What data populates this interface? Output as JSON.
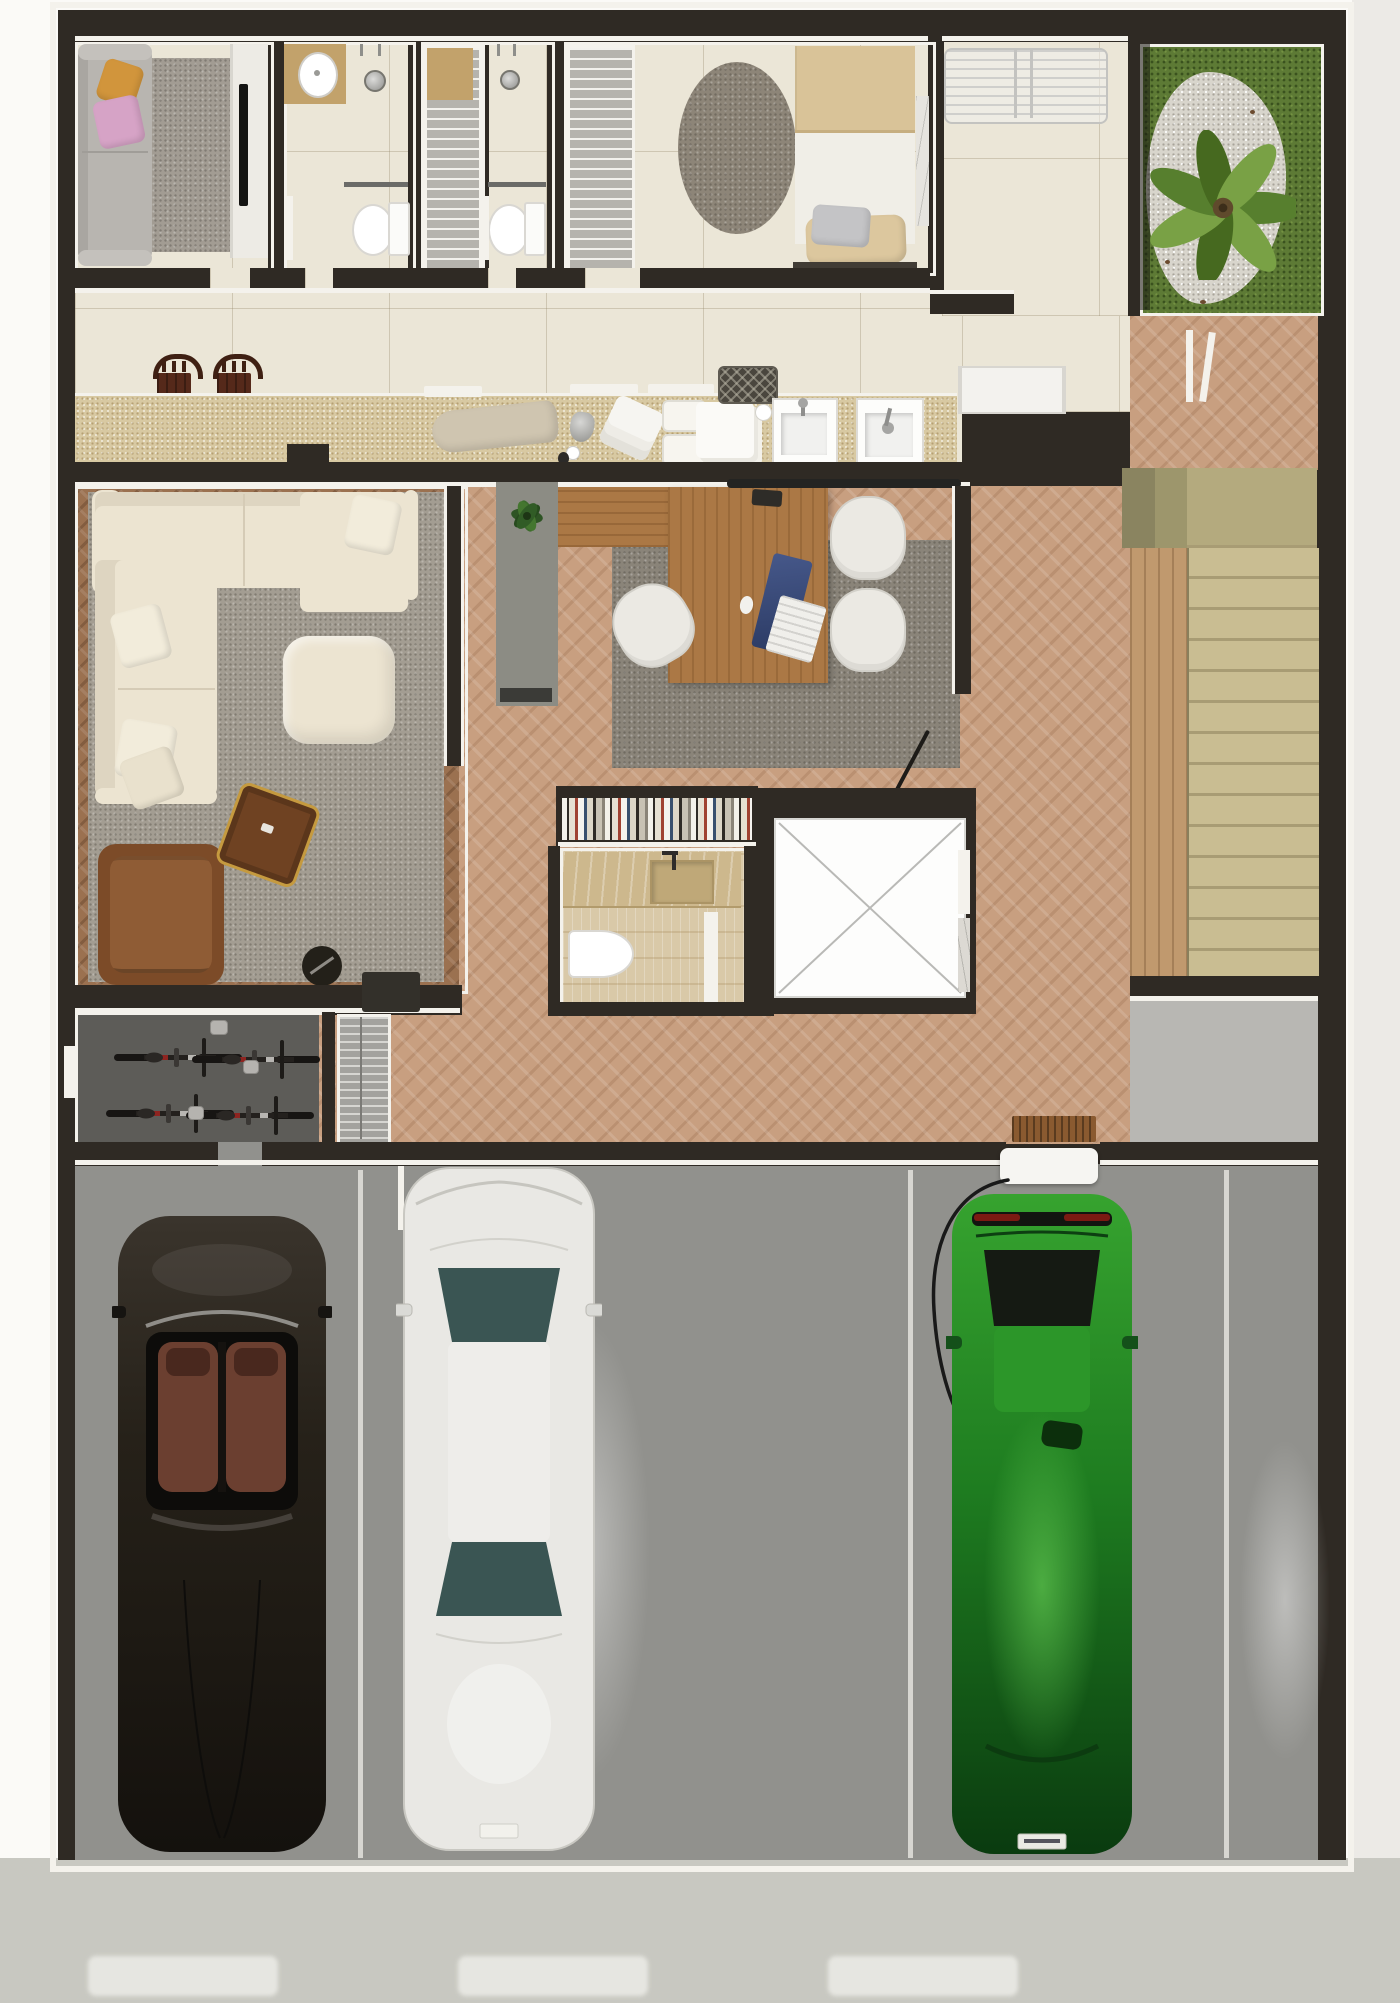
{
  "meta": {
    "title": "3D rendered residential floor plan, top-down view, ground floor with 3-car garage",
    "view": "top-down architectural render",
    "visible_text": "none"
  },
  "palette": {
    "wall": "#2f2a24",
    "trim": "#f4f2ec",
    "tile": "#ebe6d7",
    "counter": "#d8c9a2",
    "stone": "#d9c9a8",
    "woodHall": "#c89f80",
    "woodLiving": "#9b7150",
    "woodDesk": "#ab7845",
    "stairTread": "#c9bd92",
    "stairGroove": "#a89c74",
    "stairRail": "#c0996e",
    "stairBlockA": "#8a8460",
    "stairBlockB": "#9d966c",
    "landing": "#b8b7b3",
    "rugLiving": "#a39d92",
    "rugOffice": "#8a8479",
    "rugRound": "#8d8578",
    "rugLounge": "#a29c93",
    "cream": "#ece4d1",
    "creamShade": "#ded5c1",
    "pillowCream": "#f2ecdb",
    "sofaGrey": "#b8b5b0",
    "pillowOrange": "#d1953c",
    "pillowPink": "#d6a3c6",
    "leather": "#8f5c35",
    "leatherDark": "#7c4b28",
    "tableWood": "#6f4222",
    "tableGold": "#c59a3f",
    "duvet": "#d9c398",
    "sheet": "#f0eee7",
    "pillowSilver": "#c4c4c6",
    "pillowBeige": "#dcc79e",
    "bedBase": "#413c35",
    "marble": "#e6e4df",
    "grass": "#5d7a35",
    "gravel": "#d8d5cc",
    "palmA": "#577f2e",
    "palmB": "#79a145",
    "palmC": "#46691f",
    "panel": "#8c8c84",
    "bikeFloor": "#5d5c58",
    "rack": "#a3a29e",
    "stool": "#3f2013",
    "stoolSeat": "#55291a",
    "garage": "#91918d",
    "stall": "#e8e7e2",
    "driveway": "#c8c8c1",
    "dash": "#ecece7",
    "carDark": "#2e2922",
    "carSeat": "#6b3f30",
    "carWhite": "#e9e8e4",
    "glassTeal": "#3a5553",
    "carGreen": "#1e7c20",
    "carGreenHi": "#36a32f",
    "carGreenLo": "#0a3b0f",
    "tailRed": "#7c1a12",
    "elevLine": "#b9b9b6",
    "doormat": "#8a5a30",
    "cabinetWhite": "#edebe5",
    "vanity": "#c2a26b",
    "chrome": "#a5a5a3",
    "cable": "#191919",
    "woven": "#4a463e"
  },
  "rooms": [
    {
      "id": "tv-lounge",
      "furniture": [
        "grey-two-seat-sofa",
        "orange-pillow",
        "pink-pillow",
        "area-rug",
        "media-cabinet",
        "tv"
      ]
    },
    {
      "id": "bathroom-top",
      "furniture": [
        "vanity-with-round-sink",
        "shower-head",
        "glass-partition",
        "toilet",
        "door"
      ]
    },
    {
      "id": "linen-closet",
      "furniture": [
        "shelving-unit"
      ]
    },
    {
      "id": "shower-room",
      "furniture": [
        "shower-head",
        "glass-partition",
        "toilet",
        "door"
      ]
    },
    {
      "id": "bedroom",
      "furniture": [
        "wardrobe",
        "round-rug",
        "single-bed",
        "silver-pillow",
        "beige-pillow",
        "marble-side-table"
      ]
    },
    {
      "id": "laundry-terrace",
      "furniture": [
        "drying-rack"
      ]
    },
    {
      "id": "garden-patio",
      "furniture": [
        "palm-tree",
        "gravel-bed",
        "grass-lawn"
      ]
    },
    {
      "id": "hallway-laundry-counter",
      "furniture": [
        "granite-counter",
        "stool",
        "stool",
        "ironing-board",
        "iron",
        "towel-stack",
        "basket",
        "basket",
        "linen-stack",
        "cup",
        "woven-basket",
        "laundry-sink",
        "laundry-sink"
      ],
      "stools": 2,
      "sinks": 2
    },
    {
      "id": "living-room",
      "furniture": [
        "l-shaped-cream-sofa",
        "ottoman",
        "leather-armchair",
        "coffee-table",
        "robot-vacuum",
        "potted-plant",
        "grey-rug"
      ]
    },
    {
      "id": "home-office",
      "furniture": [
        "wood-desk",
        "desk-return",
        "office-chair",
        "office-chair",
        "office-chair",
        "laptop",
        "keyboard",
        "mouse",
        "grey-rug",
        "bookshelf"
      ],
      "chairs": 3
    },
    {
      "id": "powder-room",
      "furniture": [
        "stone-vanity",
        "sink",
        "toilet",
        "door"
      ]
    },
    {
      "id": "elevator",
      "furniture": [
        "elevator-car-x-symbol"
      ]
    },
    {
      "id": "staircase",
      "visible_treads": 14,
      "furniture": [
        "stringer-wall",
        "landing-blocks"
      ]
    },
    {
      "id": "bike-room",
      "bikes": 4,
      "furniture": [
        "bicycle",
        "bicycle",
        "bicycle",
        "bicycle",
        "helmet",
        "helmet",
        "helmet",
        "shoe-rack",
        "entry-console",
        "doormat"
      ]
    },
    {
      "id": "garage",
      "stalls": 3,
      "cars": [
        {
          "type": "convertible-roadster",
          "color": "dark-brown-black",
          "detail": "open-top-two-brown-seats"
        },
        {
          "type": "sedan",
          "color": "white-silver",
          "detail": "teal-glass-windshield-and-rear"
        },
        {
          "type": "sports-hatchback",
          "color": "metallic-green",
          "detail": "connected-to-ev-charger"
        }
      ],
      "furniture": [
        "ev-wall-charger",
        "charging-cable",
        "stall-divider-lines"
      ]
    },
    {
      "id": "driveway",
      "furniture": [
        "pavement",
        "light-reflection-dashes"
      ],
      "dashes": 3
    }
  ]
}
